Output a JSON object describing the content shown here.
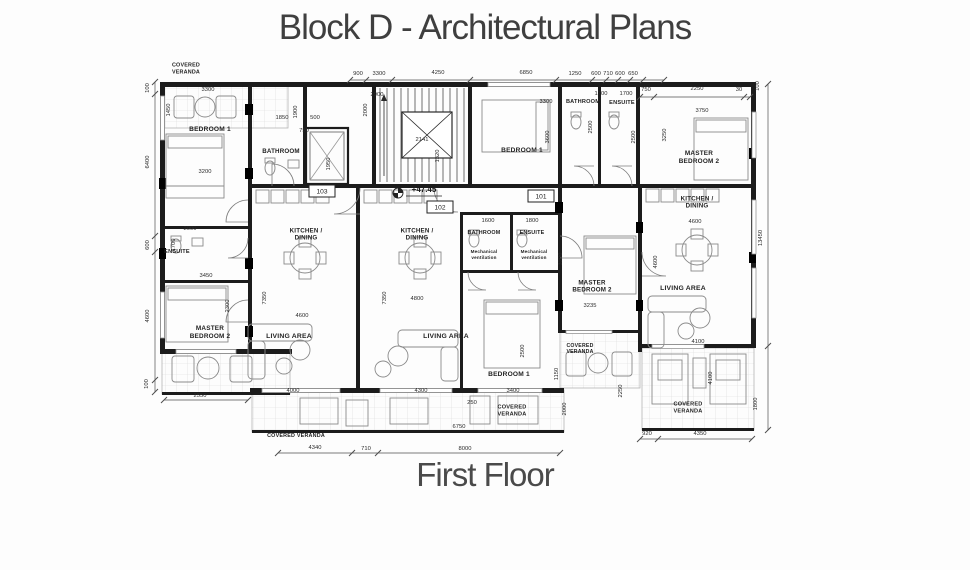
{
  "title": "Block D - Architectural Plans",
  "subtitle": "First Floor",
  "level_marker": "+47.45",
  "colors": {
    "wall": "#1c1c1c",
    "line": "#555555",
    "furniture": "#8a8a8a",
    "hatch": "#d8d8d8",
    "text": "#2b2b2b"
  },
  "room_labels": [
    {
      "t": "COVERED|VERANDA",
      "x": 186,
      "y": 70,
      "s": 5.4
    },
    {
      "t": "BEDROOM 1",
      "x": 210,
      "y": 131,
      "s": 6.6
    },
    {
      "t": "BATHROOM",
      "x": 281,
      "y": 153,
      "s": 6.2
    },
    {
      "t": "ENSUITE",
      "x": 177,
      "y": 253,
      "s": 5.6
    },
    {
      "t": "MASTER|BEDROOM 2",
      "x": 210,
      "y": 334,
      "s": 6.4
    },
    {
      "t": "KITCHEN /|DINING",
      "x": 306,
      "y": 236,
      "s": 6.2
    },
    {
      "t": "KITCHEN /|DINING",
      "x": 417,
      "y": 236,
      "s": 6.2
    },
    {
      "t": "LIVING AREA",
      "x": 289,
      "y": 338,
      "s": 6.8
    },
    {
      "t": "LIVING AREA",
      "x": 446,
      "y": 338,
      "s": 6.8
    },
    {
      "t": "BEDROOM 1",
      "x": 509,
      "y": 376,
      "s": 6.6
    },
    {
      "t": "COVERED VERANDA",
      "x": 296,
      "y": 437,
      "s": 5.4
    },
    {
      "t": "COVERED|VERANDA",
      "x": 512,
      "y": 412,
      "s": 5.6
    },
    {
      "t": "BATHROOM",
      "x": 484,
      "y": 234,
      "s": 5.4
    },
    {
      "t": "ENSUITE",
      "x": 532,
      "y": 234,
      "s": 5.4
    },
    {
      "t": "Mechanical|ventilation",
      "x": 484,
      "y": 256,
      "s": 4.6,
      "w": "normal"
    },
    {
      "t": "Mechanical|ventilation",
      "x": 534,
      "y": 256,
      "s": 4.6,
      "w": "normal"
    },
    {
      "t": "MASTER|BEDROOM 2",
      "x": 592,
      "y": 288,
      "s": 6.2
    },
    {
      "t": "COVERED|VERANDA",
      "x": 580,
      "y": 350,
      "s": 5.2
    },
    {
      "t": "BEDROOM 1",
      "x": 522,
      "y": 152,
      "s": 6.6
    },
    {
      "t": "BATHROOM",
      "x": 583,
      "y": 103,
      "s": 5.6
    },
    {
      "t": "ENSUITE",
      "x": 622,
      "y": 104,
      "s": 5.6
    },
    {
      "t": "MASTER|BEDROOM 2",
      "x": 699,
      "y": 159,
      "s": 6.4
    },
    {
      "t": "KITCHEN /|DINING",
      "x": 697,
      "y": 204,
      "s": 6.2
    },
    {
      "t": "LIVING AREA",
      "x": 683,
      "y": 290,
      "s": 6.8
    },
    {
      "t": "COVERED|VERANDA",
      "x": 688,
      "y": 409,
      "s": 5.6
    }
  ],
  "dimensions": [
    {
      "t": "900",
      "x": 358,
      "y": 75
    },
    {
      "t": "3300",
      "x": 379,
      "y": 75
    },
    {
      "t": "4250",
      "x": 438,
      "y": 74
    },
    {
      "t": "6850",
      "x": 526,
      "y": 74
    },
    {
      "t": "1250",
      "x": 575,
      "y": 75
    },
    {
      "t": "600",
      "x": 596,
      "y": 75
    },
    {
      "t": "710",
      "x": 608,
      "y": 75
    },
    {
      "t": "600",
      "x": 620,
      "y": 75
    },
    {
      "t": "650",
      "x": 633,
      "y": 75
    },
    {
      "t": "750",
      "x": 646,
      "y": 91
    },
    {
      "t": "2250",
      "x": 697,
      "y": 90
    },
    {
      "t": "30",
      "x": 739,
      "y": 91
    },
    {
      "t": "100",
      "x": 759,
      "y": 86,
      "r": -90
    },
    {
      "t": "3300",
      "x": 208,
      "y": 91
    },
    {
      "t": "1450",
      "x": 170,
      "y": 110,
      "r": -90
    },
    {
      "t": "1900",
      "x": 297,
      "y": 112,
      "r": -90
    },
    {
      "t": "1850",
      "x": 282,
      "y": 119
    },
    {
      "t": "500",
      "x": 315,
      "y": 119
    },
    {
      "t": "750",
      "x": 304,
      "y": 132
    },
    {
      "t": "1950",
      "x": 330,
      "y": 164,
      "r": -90
    },
    {
      "t": "2900",
      "x": 377,
      "y": 96
    },
    {
      "t": "2000",
      "x": 367,
      "y": 110,
      "r": -90
    },
    {
      "t": "2141",
      "x": 422,
      "y": 141
    },
    {
      "t": "1320",
      "x": 439,
      "y": 156,
      "r": -90
    },
    {
      "t": "3300",
      "x": 546,
      "y": 103
    },
    {
      "t": "3600",
      "x": 549,
      "y": 137,
      "r": -90
    },
    {
      "t": "1700",
      "x": 601,
      "y": 95
    },
    {
      "t": "1700",
      "x": 626,
      "y": 95
    },
    {
      "t": "2500",
      "x": 592,
      "y": 127,
      "r": -90
    },
    {
      "t": "2500",
      "x": 635,
      "y": 137,
      "r": -90
    },
    {
      "t": "3750",
      "x": 702,
      "y": 112
    },
    {
      "t": "3250",
      "x": 666,
      "y": 135,
      "r": -90
    },
    {
      "t": "100",
      "x": 149,
      "y": 88,
      "r": -90
    },
    {
      "t": "6400",
      "x": 149,
      "y": 162,
      "r": -90
    },
    {
      "t": "600",
      "x": 149,
      "y": 245,
      "r": -90
    },
    {
      "t": "4600",
      "x": 149,
      "y": 316,
      "r": -90
    },
    {
      "t": "100",
      "x": 148,
      "y": 384,
      "r": -90
    },
    {
      "t": "3200",
      "x": 205,
      "y": 173
    },
    {
      "t": "2000",
      "x": 190,
      "y": 230
    },
    {
      "t": "1700",
      "x": 175,
      "y": 245,
      "r": -90
    },
    {
      "t": "3450",
      "x": 206,
      "y": 277
    },
    {
      "t": "2300",
      "x": 229,
      "y": 306,
      "r": -90
    },
    {
      "t": "2550",
      "x": 200,
      "y": 397
    },
    {
      "t": "7350",
      "x": 266,
      "y": 298,
      "r": -90
    },
    {
      "t": "7350",
      "x": 386,
      "y": 298,
      "r": -90
    },
    {
      "t": "4600",
      "x": 302,
      "y": 317
    },
    {
      "t": "4800",
      "x": 417,
      "y": 300
    },
    {
      "t": "1600",
      "x": 488,
      "y": 222
    },
    {
      "t": "1800",
      "x": 532,
      "y": 222
    },
    {
      "t": "3200",
      "x": 562,
      "y": 259,
      "r": -90
    },
    {
      "t": "3235",
      "x": 590,
      "y": 307
    },
    {
      "t": "2500",
      "x": 524,
      "y": 351,
      "r": -90
    },
    {
      "t": "3400",
      "x": 513,
      "y": 392
    },
    {
      "t": "250",
      "x": 472,
      "y": 404
    },
    {
      "t": "4000",
      "x": 293,
      "y": 392
    },
    {
      "t": "4300",
      "x": 421,
      "y": 392
    },
    {
      "t": "6750",
      "x": 459,
      "y": 428
    },
    {
      "t": "4600",
      "x": 657,
      "y": 262,
      "r": -90
    },
    {
      "t": "4600",
      "x": 695,
      "y": 223
    },
    {
      "t": "13450",
      "x": 762,
      "y": 238,
      "r": -90
    },
    {
      "t": "4100",
      "x": 698,
      "y": 343
    },
    {
      "t": "4100",
      "x": 712,
      "y": 378,
      "r": -90
    },
    {
      "t": "1150",
      "x": 558,
      "y": 374,
      "r": -90
    },
    {
      "t": "2000",
      "x": 566,
      "y": 409,
      "r": -90
    },
    {
      "t": "2250",
      "x": 622,
      "y": 391,
      "r": -90
    },
    {
      "t": "1800",
      "x": 757,
      "y": 404,
      "r": -90
    },
    {
      "t": "920",
      "x": 647,
      "y": 435
    },
    {
      "t": "4350",
      "x": 700,
      "y": 435
    },
    {
      "t": "4340",
      "x": 315,
      "y": 449
    },
    {
      "t": "710",
      "x": 366,
      "y": 450
    },
    {
      "t": "8000",
      "x": 465,
      "y": 450
    }
  ],
  "room_markers": [
    {
      "n": "103",
      "x": 322,
      "y": 191
    },
    {
      "n": "102",
      "x": 440,
      "y": 207
    },
    {
      "n": "101",
      "x": 541,
      "y": 196
    }
  ]
}
